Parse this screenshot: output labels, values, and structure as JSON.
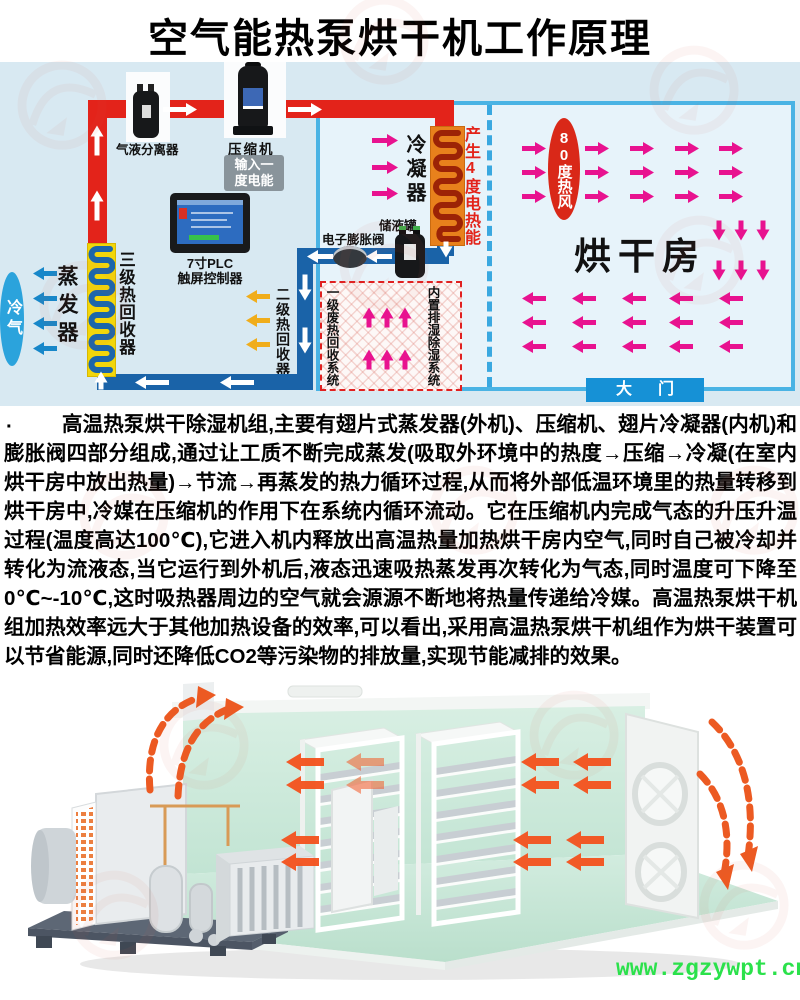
{
  "title": "空气能热泵烘干机工作原理",
  "diagram": {
    "gas_liquid_separator": "气液分离器",
    "compressor": "压缩机",
    "input_power_1": "输入一",
    "input_power_2": "度电能",
    "condenser": "冷凝器",
    "produce_power": "产生4度电热能",
    "plc_1": "7寸PLC",
    "plc_2": "触屏控制器",
    "evaporator": "蒸发器",
    "cold_air": "冷气",
    "heat_recovery_3": "三级热回收器",
    "heat_recovery_2": "二级热回收器",
    "expansion_valve": "电子膨胀阀",
    "liquid_tank": "储液罐",
    "waste_heat_recovery": "一级废热回收系统",
    "dehumid_system": "内置排湿除湿系统",
    "hot_wind_80": "80度热风",
    "drying_room": "烘干房",
    "gate": "大门"
  },
  "description": {
    "bullet": "·",
    "body": "高温热泵烘干除湿机组,主要有翅片式蒸发器(外机)、压缩机、翅片冷凝器(内机)和膨胀阀四部分组成,通过让工质不断完成蒸发(吸取外环境中的热度→压缩→冷凝(在室内烘干房中放出热量)→节流→再蒸发的热力循环过程,从而将外部低温环境里的热量转移到烘干房中,冷媒在压缩机的作用下在系统内循环流动。它在压缩机内完成气态的升压升温过程(温度高达100℃),它进入机内释放出高温热量加热烘干房内空气,同时自己被冷却并转化为流液态,当它运行到外机后,液态迅速吸热蒸发再次转化为气态,同时温度可下降至0℃~-10℃,这时吸热器周边的空气就会源源不断地将热量传递给冷媒。高温热泵烘干机组加热效率远大于其他加热设备的效率,可以看出,采用高温热泵烘干机组作为烘干装置可以节省能源,同时还降低CO2等污染物的排放量,实现节能减排的效果。"
  },
  "footer": {
    "url": "www.zgzywpt.cn"
  },
  "colors": {
    "hot_pipe": "#e3231a",
    "cold_pipe": "#1a63a8",
    "frame_cyan": "#4ab3e4",
    "magenta_arrow": "#e8128f",
    "yellow_arrow": "#f0ad1b",
    "url_green": "#2be14b"
  }
}
